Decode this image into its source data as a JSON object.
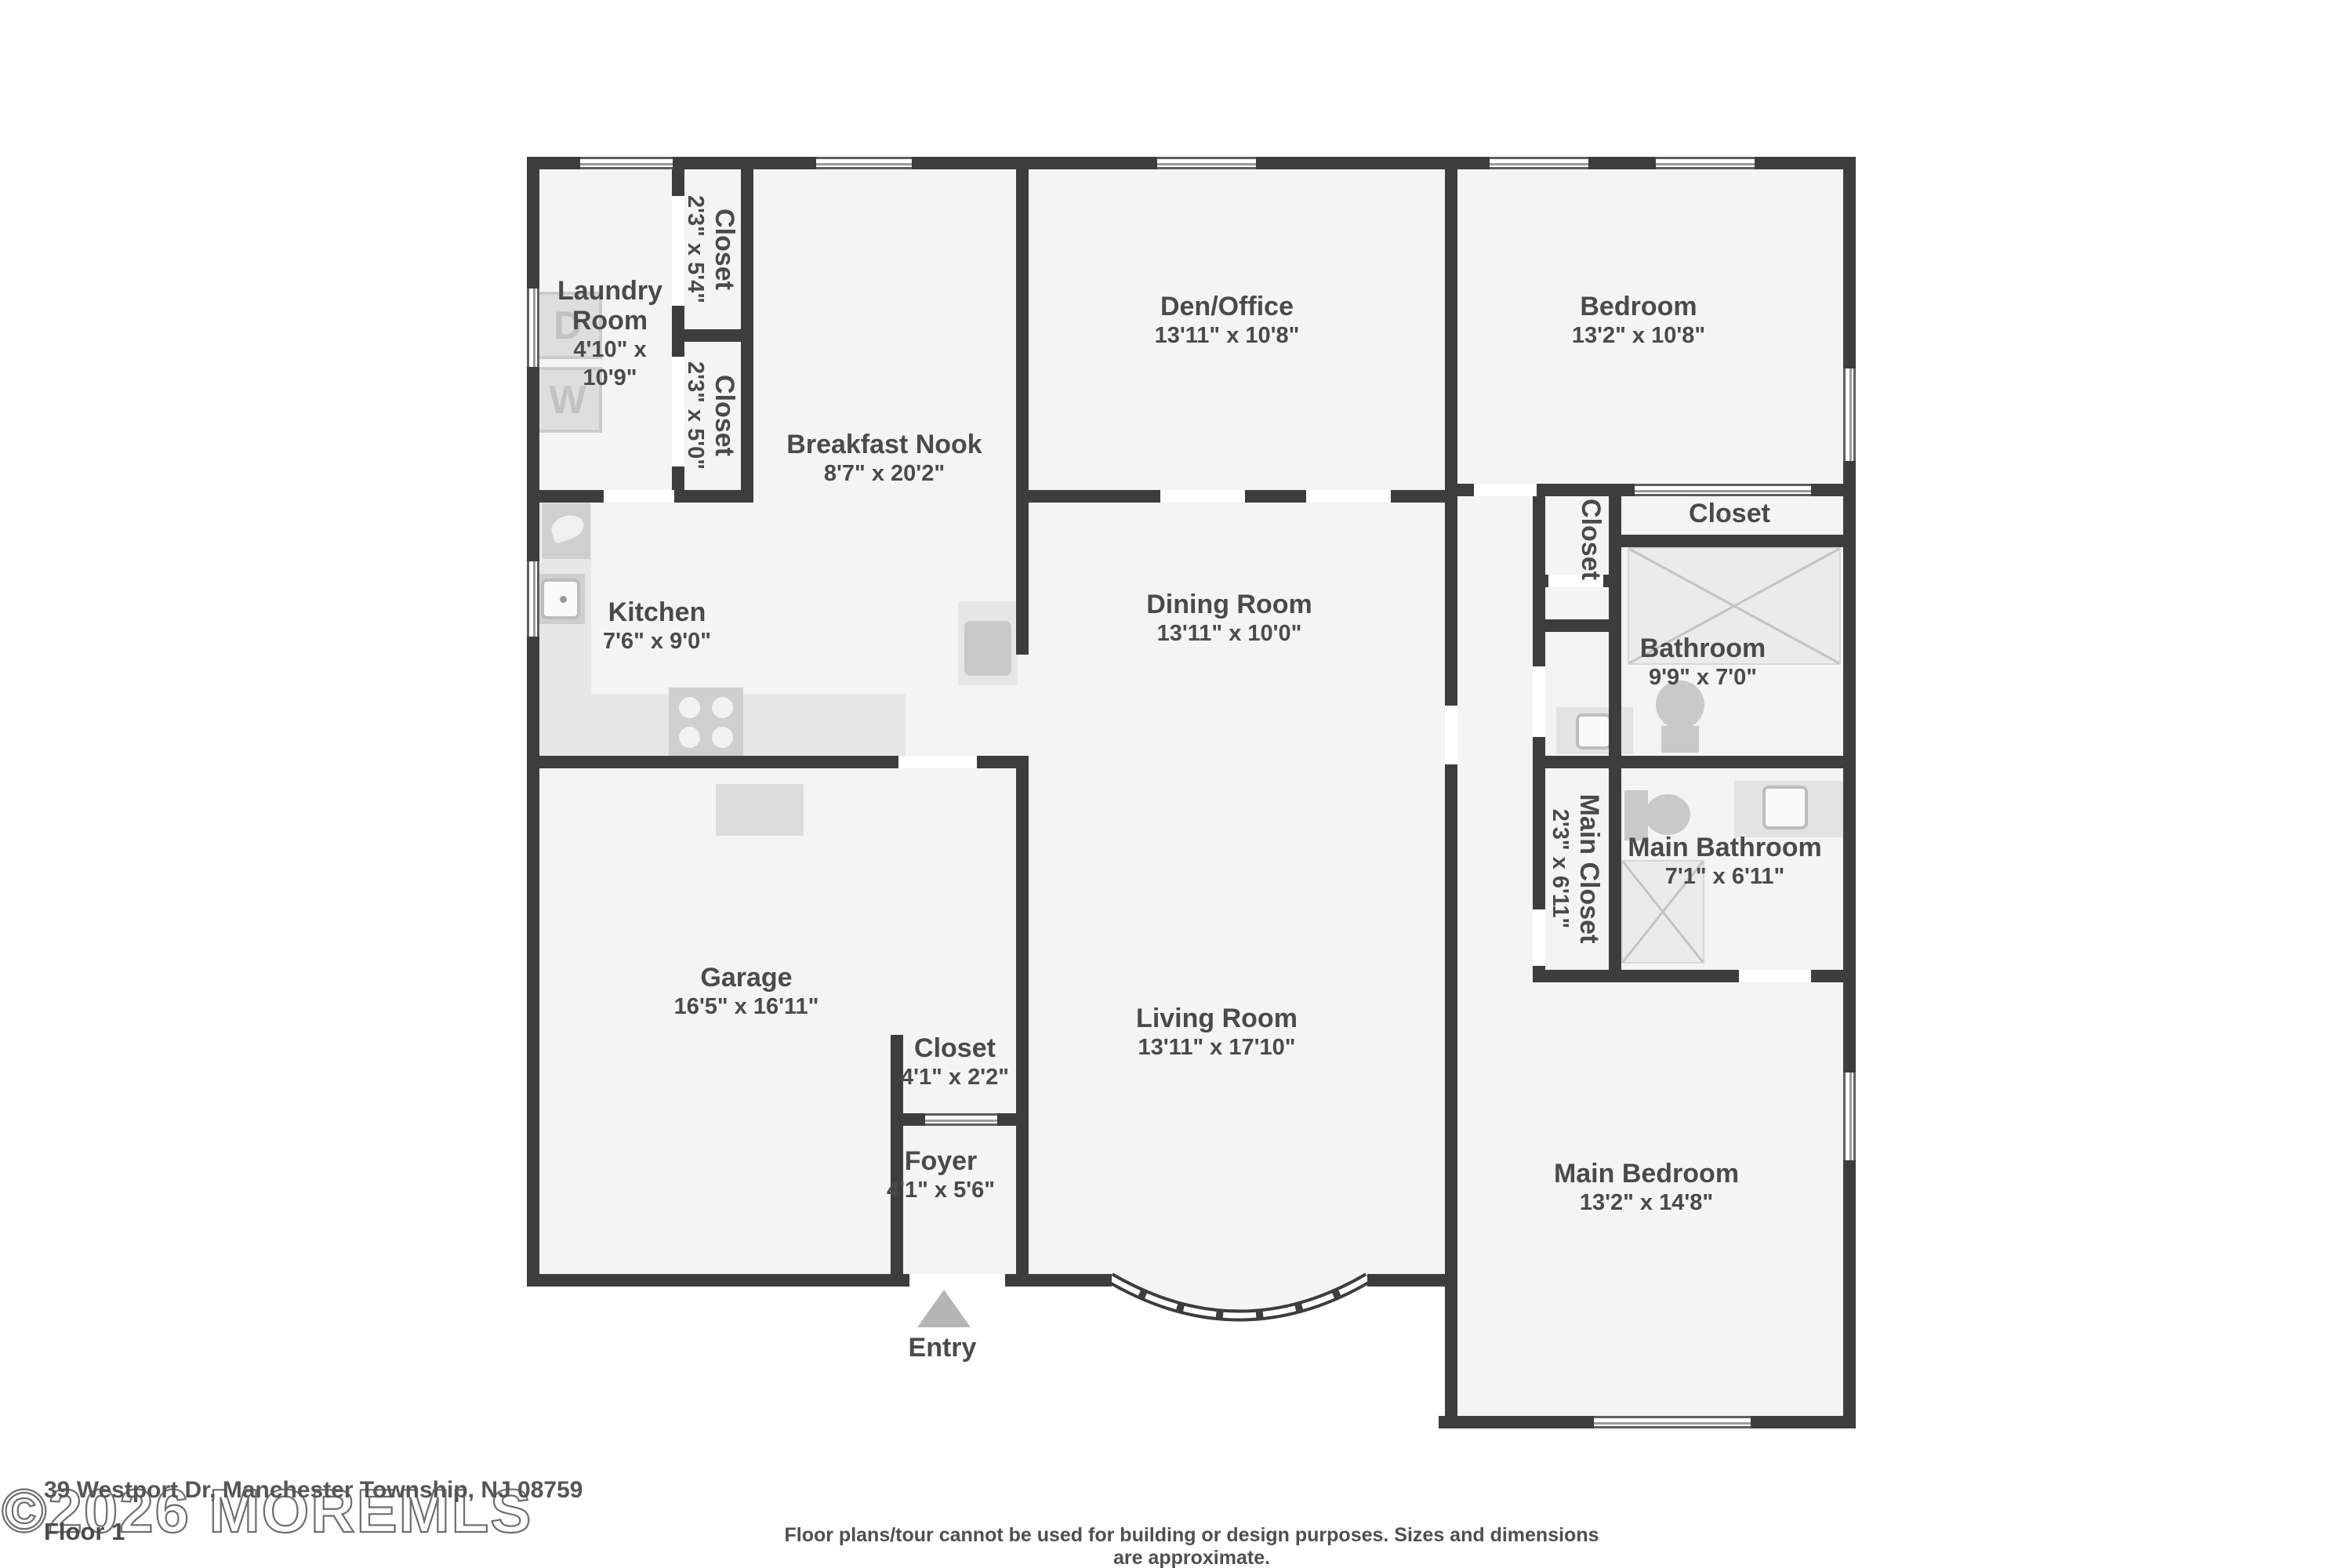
{
  "floorplan": {
    "rooms": [
      {
        "name": "Laundry Room",
        "dims": "4'10\" x 10'9\""
      },
      {
        "name": "Closet",
        "dims": "2'3\" x 5'4\""
      },
      {
        "name": "Closet",
        "dims": "2'3\" x 5'0\""
      },
      {
        "name": "Breakfast Nook",
        "dims": "8'7\" x 20'2\""
      },
      {
        "name": "Den/Office",
        "dims": "13'11\" x 10'8\""
      },
      {
        "name": "Bedroom",
        "dims": "13'2\" x 10'8\""
      },
      {
        "name": "Kitchen",
        "dims": "7'6\" x 9'0\""
      },
      {
        "name": "Dining Room",
        "dims": "13'11\" x 10'0\""
      },
      {
        "name": "Closet",
        "dims": ""
      },
      {
        "name": "Closet",
        "dims": ""
      },
      {
        "name": "Bathroom",
        "dims": "9'9\" x 7'0\""
      },
      {
        "name": "Main Closet",
        "dims": "2'3\" x 6'11\""
      },
      {
        "name": "Main Bathroom",
        "dims": "7'1\" x 6'11\""
      },
      {
        "name": "Garage",
        "dims": "16'5\" x 16'11\""
      },
      {
        "name": "Closet",
        "dims": "4'1\" x 2'2\""
      },
      {
        "name": "Living Room",
        "dims": "13'11\" x 17'10\""
      },
      {
        "name": "Foyer",
        "dims": "4'1\" x 5'6\""
      },
      {
        "name": "Main Bedroom",
        "dims": "13'2\" x 14'8\""
      }
    ],
    "entry_label": "Entry",
    "fixtures": {
      "washer": "W",
      "dryer": "D"
    },
    "footer": {
      "address": "39 Westport Dr, Manchester Township, NJ 08759",
      "floor_label": "Floor 1",
      "watermark": "©2026 MOREMLS",
      "disclaimer": "Floor plans/tour cannot be used for building or design purposes. Sizes and dimensions are approximate."
    },
    "colors": {
      "wall": "#3d3d3d",
      "floor": "#f4f4f4",
      "fixture": "#d8d8d8",
      "label": "#4a4a4a"
    }
  }
}
